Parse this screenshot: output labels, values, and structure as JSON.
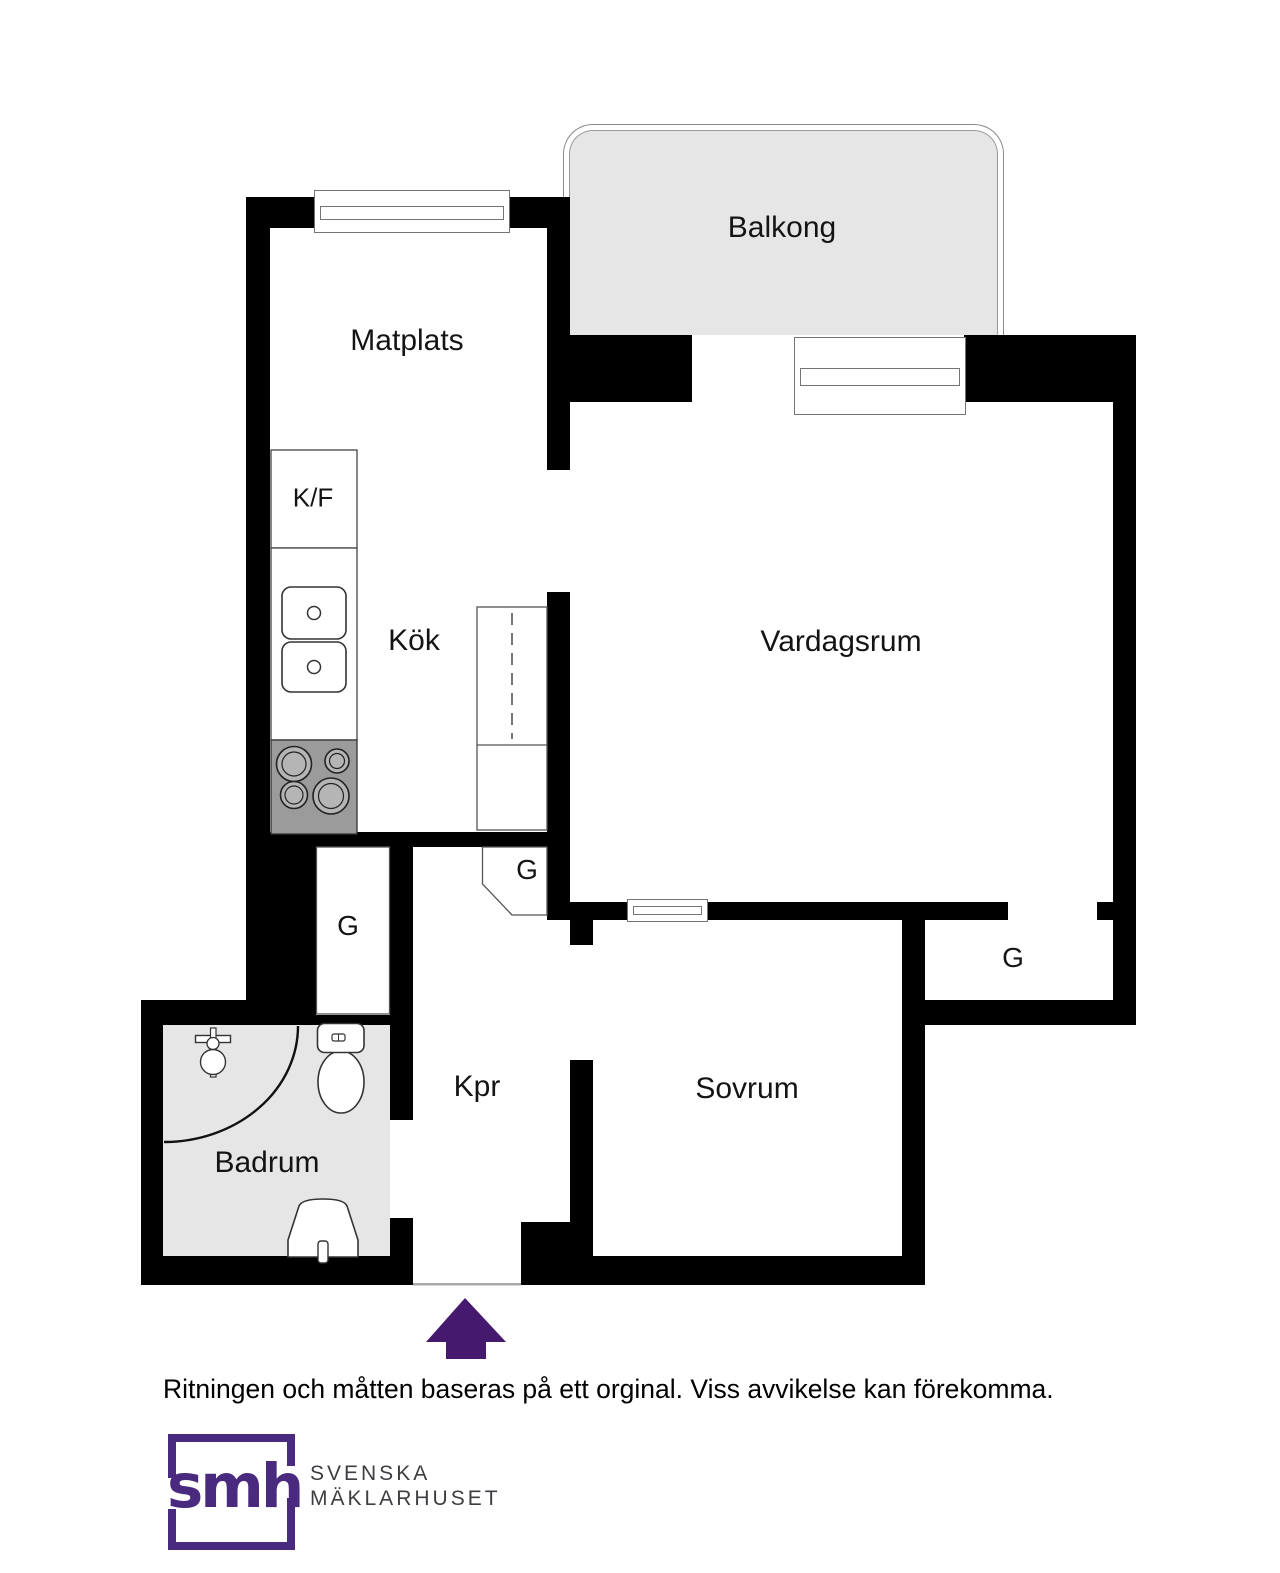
{
  "plan": {
    "rooms": {
      "balcony": "Balkong",
      "dining": "Matplats",
      "fridge_freezer": "K/F",
      "kitchen": "Kök",
      "living": "Vardagsrum",
      "hall": "Kpr",
      "bedroom": "Sovrum",
      "bathroom": "Badrum"
    },
    "closets": [
      "G",
      "G",
      "G"
    ]
  },
  "footer": {
    "disclaimer": "Ritningen och måtten baseras på ett orginal. Viss avvikelse kan förekomma."
  },
  "logo": {
    "monogram": "smh",
    "line1": "SVENSKA",
    "line2": "MÄKLARHUSET"
  },
  "colors": {
    "wall": "#000000",
    "balcony_fill": "#e6e6e6",
    "bathroom_floor": "#e6e6e6",
    "stove_fill": "#9b9b9b",
    "brand_purple": "#4a2a7e",
    "arrow_purple": "#451a6e",
    "label_text": "#141414",
    "brand_text": "#3e3e42"
  }
}
